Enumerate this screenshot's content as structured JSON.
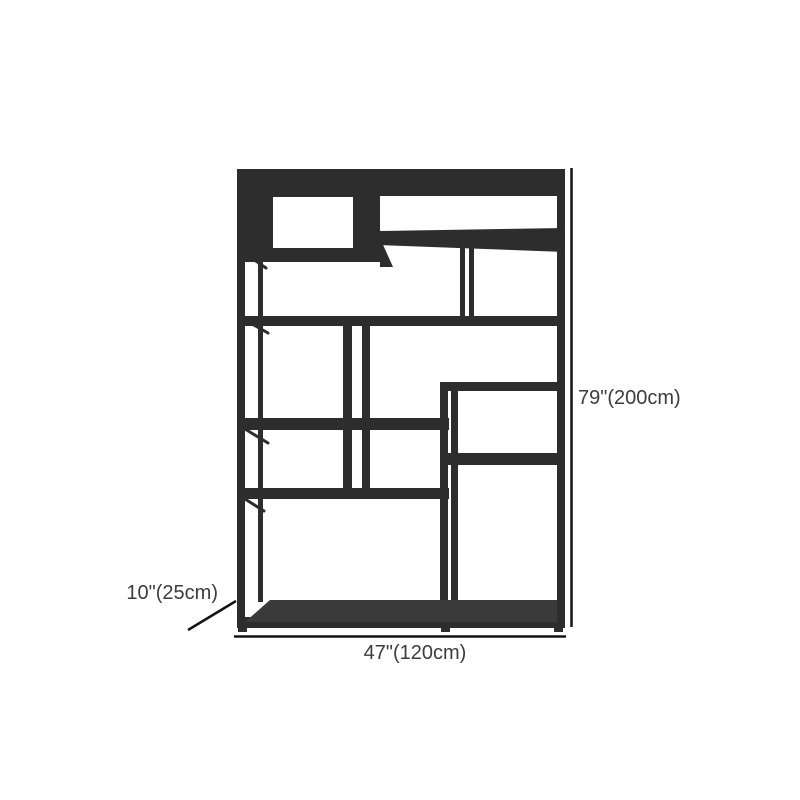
{
  "diagram": {
    "product": "open-shelf-bookcase",
    "labels": {
      "height": "79\"(200cm)",
      "width": "47\"(120cm)",
      "depth": "10\"(25cm)"
    },
    "colors": {
      "shelf_body": "#2d2d2d",
      "shelf_surface": "#3a3a3a",
      "opening": "#ffffff",
      "dimension_line": "#141414",
      "label_text": "#3c3c3c",
      "background": "#ffffff"
    }
  }
}
